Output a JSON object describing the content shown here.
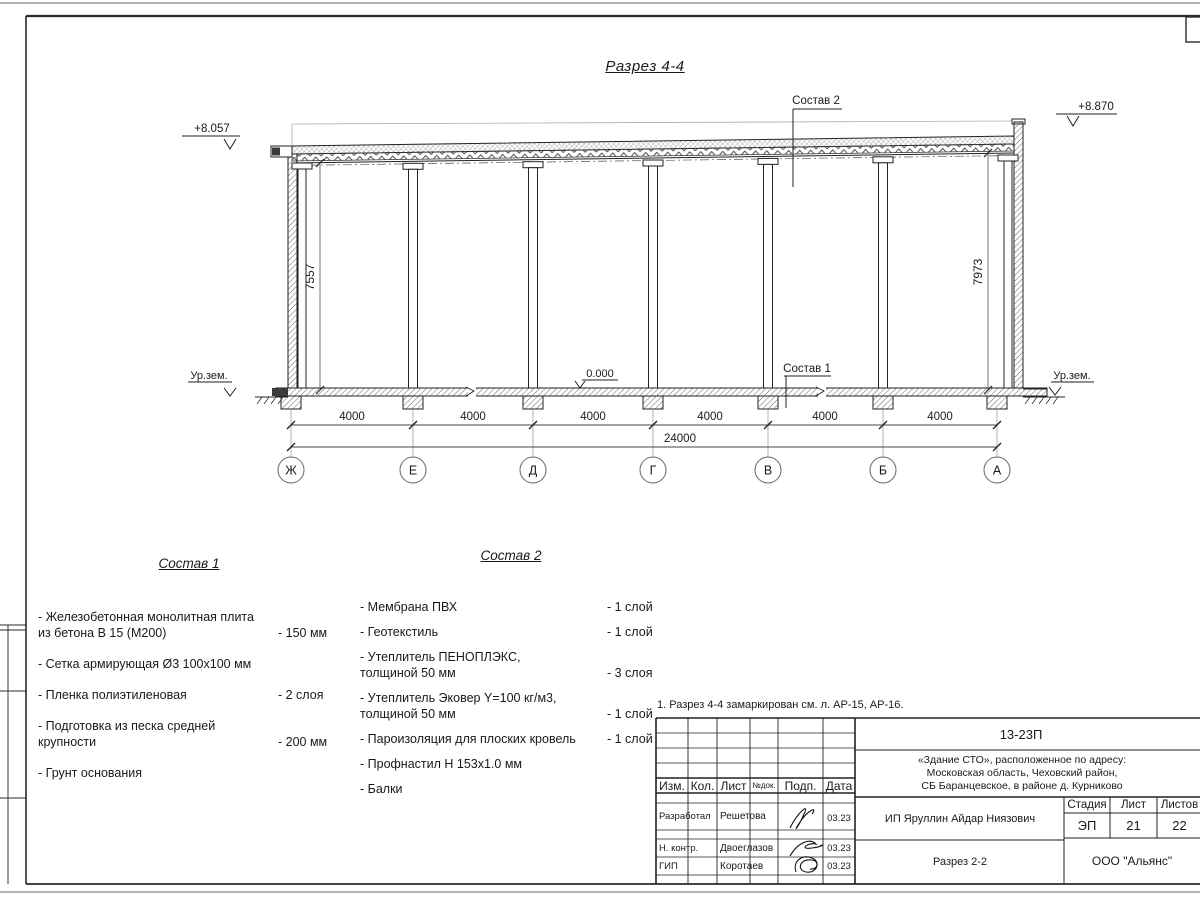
{
  "sheet": {
    "title": "Разрез 4-4",
    "note": "1. Разрез 4-4 замаркирован см. л. АР-15, АР-16."
  },
  "drawing": {
    "elevation_left_top": "+8.057",
    "elevation_right_top": "+8.870",
    "elevation_floor": "0.000",
    "ground_label_left": "Ур.зем.",
    "ground_label_right": "Ур.зем.",
    "vertical_dim_left": "7557",
    "vertical_dim_right": "7973",
    "leader_roof": "Состав 2",
    "leader_floor": "Состав 1",
    "bay_dims": [
      "4000",
      "4000",
      "4000",
      "4000",
      "4000",
      "4000"
    ],
    "total_dim": "24000",
    "axes": [
      "Ж",
      "Е",
      "Д",
      "Г",
      "В",
      "Б",
      "А"
    ]
  },
  "composition1": {
    "title": "Состав 1",
    "items": [
      {
        "name": "- Железобетонная  монолитная плита\nиз бетона В 15 (М200)",
        "value": "- 150 мм"
      },
      {
        "name": "- Сетка армирующая Ø3 100х100 мм",
        "value": ""
      },
      {
        "name": "- Пленка полиэтиленовая",
        "value": "-  2 слоя"
      },
      {
        "name": "- Подготовка из песка средней\nкрупности",
        "value": "- 200 мм"
      },
      {
        "name": "- Грунт основания",
        "value": ""
      }
    ]
  },
  "composition2": {
    "title": "Состав 2",
    "items": [
      {
        "name": "- Мембрана ПВХ",
        "value": "- 1 слой"
      },
      {
        "name": "- Геотекстиль",
        "value": "- 1 слой"
      },
      {
        "name": "- Утеплитель ПЕНОПЛЭКС,\nтолщиной 50 мм",
        "value": "- 3 слоя"
      },
      {
        "name": "- Утеплитель Эковер Y=100 кг/м3,\nтолщиной 50 мм",
        "value": "- 1 слой"
      },
      {
        "name": "- Пароизоляция для плоских кровель",
        "value": "- 1 слой"
      },
      {
        "name": "- Профнастил Н 153х1.0 мм",
        "value": ""
      },
      {
        "name": "- Балки",
        "value": ""
      }
    ]
  },
  "titleblock": {
    "doc_number": "13-23П",
    "project": "«Здание СТО», расположенное по адресу:\nМосковская область, Чеховский район,\nСБ Баранцевское, в районе д. Курниково",
    "header": {
      "izm": "Изм.",
      "kol": "Кол.",
      "list": "Лист",
      "ndok": "№док.",
      "podp": "Подп.",
      "data": "Дата"
    },
    "rows": [
      {
        "role": "Разработал",
        "name": "Решетова",
        "date": "03.23"
      },
      {
        "role": "Н. контр.",
        "name": "Двоеглазов",
        "date": "03.23"
      },
      {
        "role": "ГИП",
        "name": "Коротаев",
        "date": "03.23"
      }
    ],
    "client": "ИП Яруллин Айдар Ниязович",
    "stage_label": "Стадия",
    "sheet_label": "Лист",
    "sheets_label": "Листов",
    "stage": "ЭП",
    "sheet_num": "21",
    "sheets_total": "22",
    "drawing_name": "Разрез 2-2",
    "company": "ООО \"Альянс\""
  }
}
